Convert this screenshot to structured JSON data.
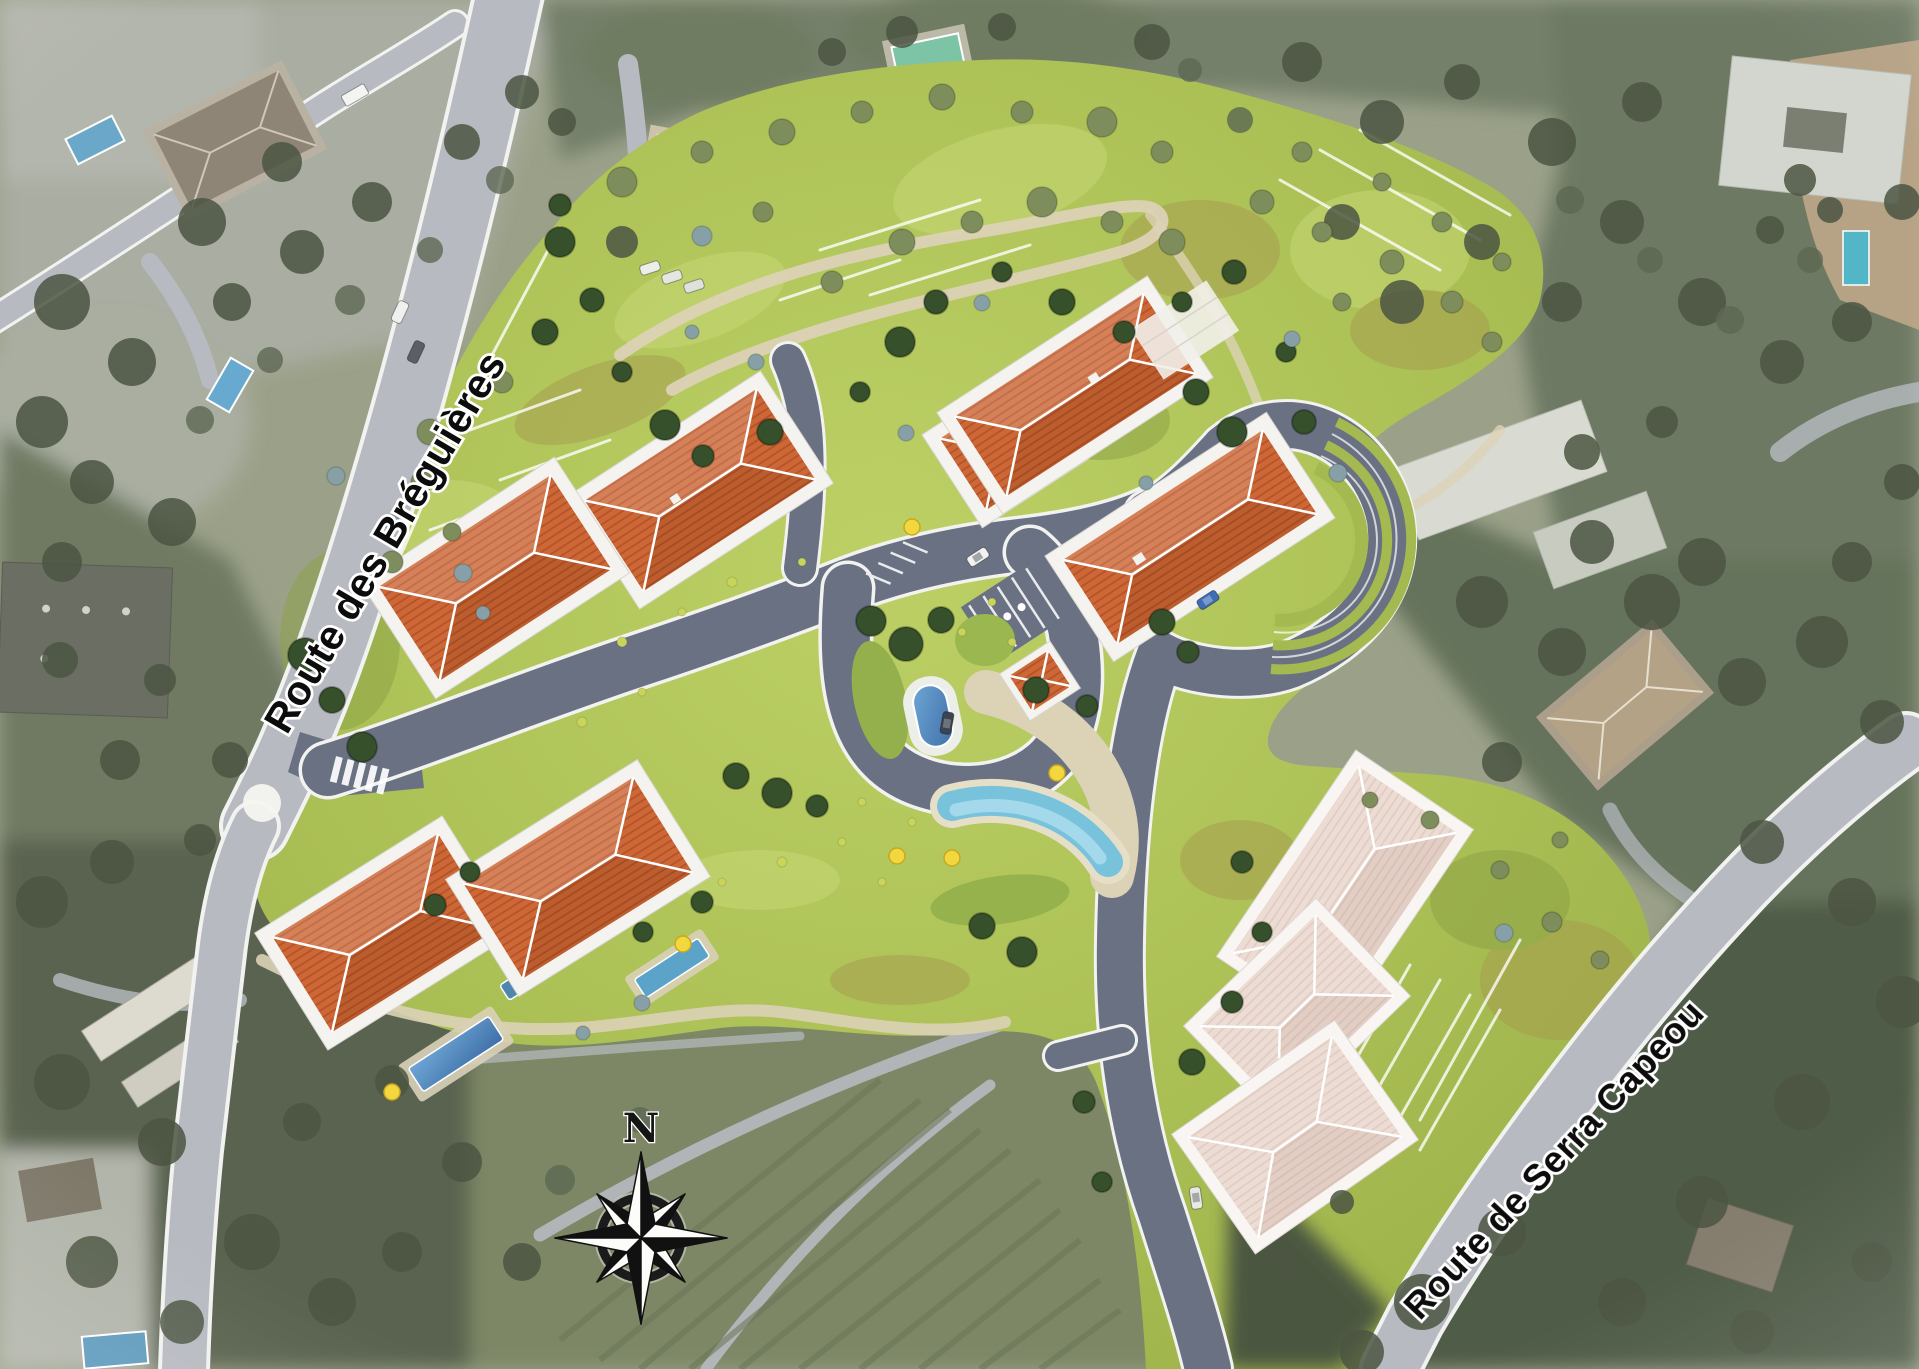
{
  "scene": {
    "description": "Aerial photomontage master plan of a hillside residential development with terracotta-roofed buildings, gardens, pools and internal roads"
  },
  "labels": {
    "road_left": "Route des Bréguières",
    "road_right": "Route de Serra Capeou",
    "compass_north": "N"
  },
  "features": {
    "orange_roof_buildings": 6,
    "pale_roof_buildings": 3,
    "garden_pavilion": 1,
    "central_lap_pool": 1,
    "lagoon_pool": 1,
    "villa_pools": 2,
    "compass_rose": 1
  },
  "colors": {
    "site_grass": "#aabf54",
    "orange_roof": "#cd6836",
    "pale_roof": "#ecdcd4",
    "internal_road": "#6a7183",
    "public_road": "#b7bac0",
    "pool_water": "#4e86b8",
    "lagoon_water": "#79c2dc",
    "stone_path": "#dcd2b6",
    "parasol_yellow": "#f2d73e"
  }
}
